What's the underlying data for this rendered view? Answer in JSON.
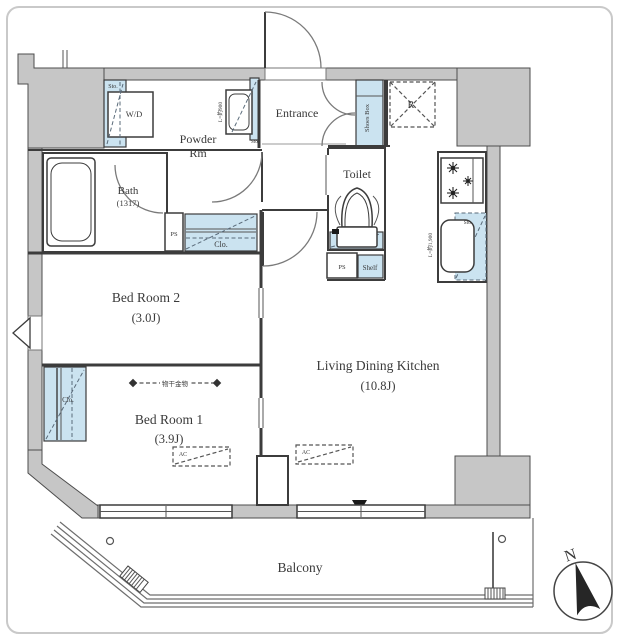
{
  "title": "apartment-floor-plan",
  "colors": {
    "wall": "#c6c6c6",
    "storage_blue": "#cbe3f0",
    "line": "#3c3c3c",
    "accent_dark": "#262626"
  },
  "labels": {
    "powder_line1": "Powder",
    "powder_line2": "Rm",
    "entrance": "Entrance",
    "toilet": "Toilet",
    "bath_name": "Bath",
    "bath_size": "(1317)",
    "bedroom2_name": "Bed Room 2",
    "bedroom2_size": "(3.0J)",
    "bedroom1_name": "Bed Room 1",
    "bedroom1_size": "(3.9J)",
    "ldk_name": "Living Dining Kitchen",
    "ldk_size": "(10.8J)",
    "balcony": "Balcony",
    "washer_dryer": "W/D",
    "refrigerator": "R",
    "shoes_box": "Shoes Box",
    "shelf": "Shelf",
    "ps_bath": "PS",
    "ps_toilet": "PS",
    "clo_hall": "Clo.",
    "clo_bedroom1": "Clo.",
    "sto_wd": "Sto.",
    "sto_vanity": "Sto.",
    "sto_toilet": "Sto.",
    "sto_kitchen": "Sto.",
    "ac_bedroom1": "AC",
    "ac_ldk": "AC",
    "vanity_length": "L=約900",
    "kitchen_length": "L=約1,900",
    "laundry_pole": "物干金物",
    "north": "N"
  }
}
